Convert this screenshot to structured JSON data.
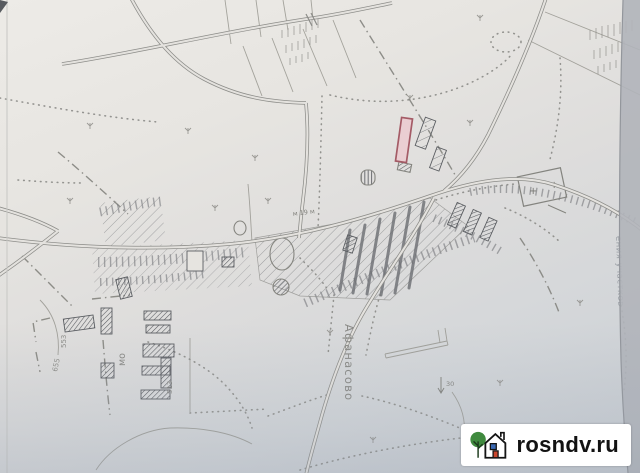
{
  "map": {
    "labels": {
      "village": "Афанасово",
      "mo": "мо",
      "road_width": "м 19 м",
      "num_513": "513",
      "num_553": "553",
      "num_655": "655",
      "num_30": "30",
      "cemetery_plus": "+",
      "edge_text": "ения участков"
    },
    "colors": {
      "paper": "#e7e5e1",
      "line": "#8a8a86",
      "hatch": "#6e7076",
      "plot_stroke": "#a8525e",
      "plot_fill": "#f1cfd4"
    }
  },
  "watermark": {
    "text": "rosndv.ru",
    "logo": "tree-house-logo",
    "tree_green": "#3f8a3e",
    "window_blue": "#3b69b3",
    "door_red": "#c9452c"
  }
}
